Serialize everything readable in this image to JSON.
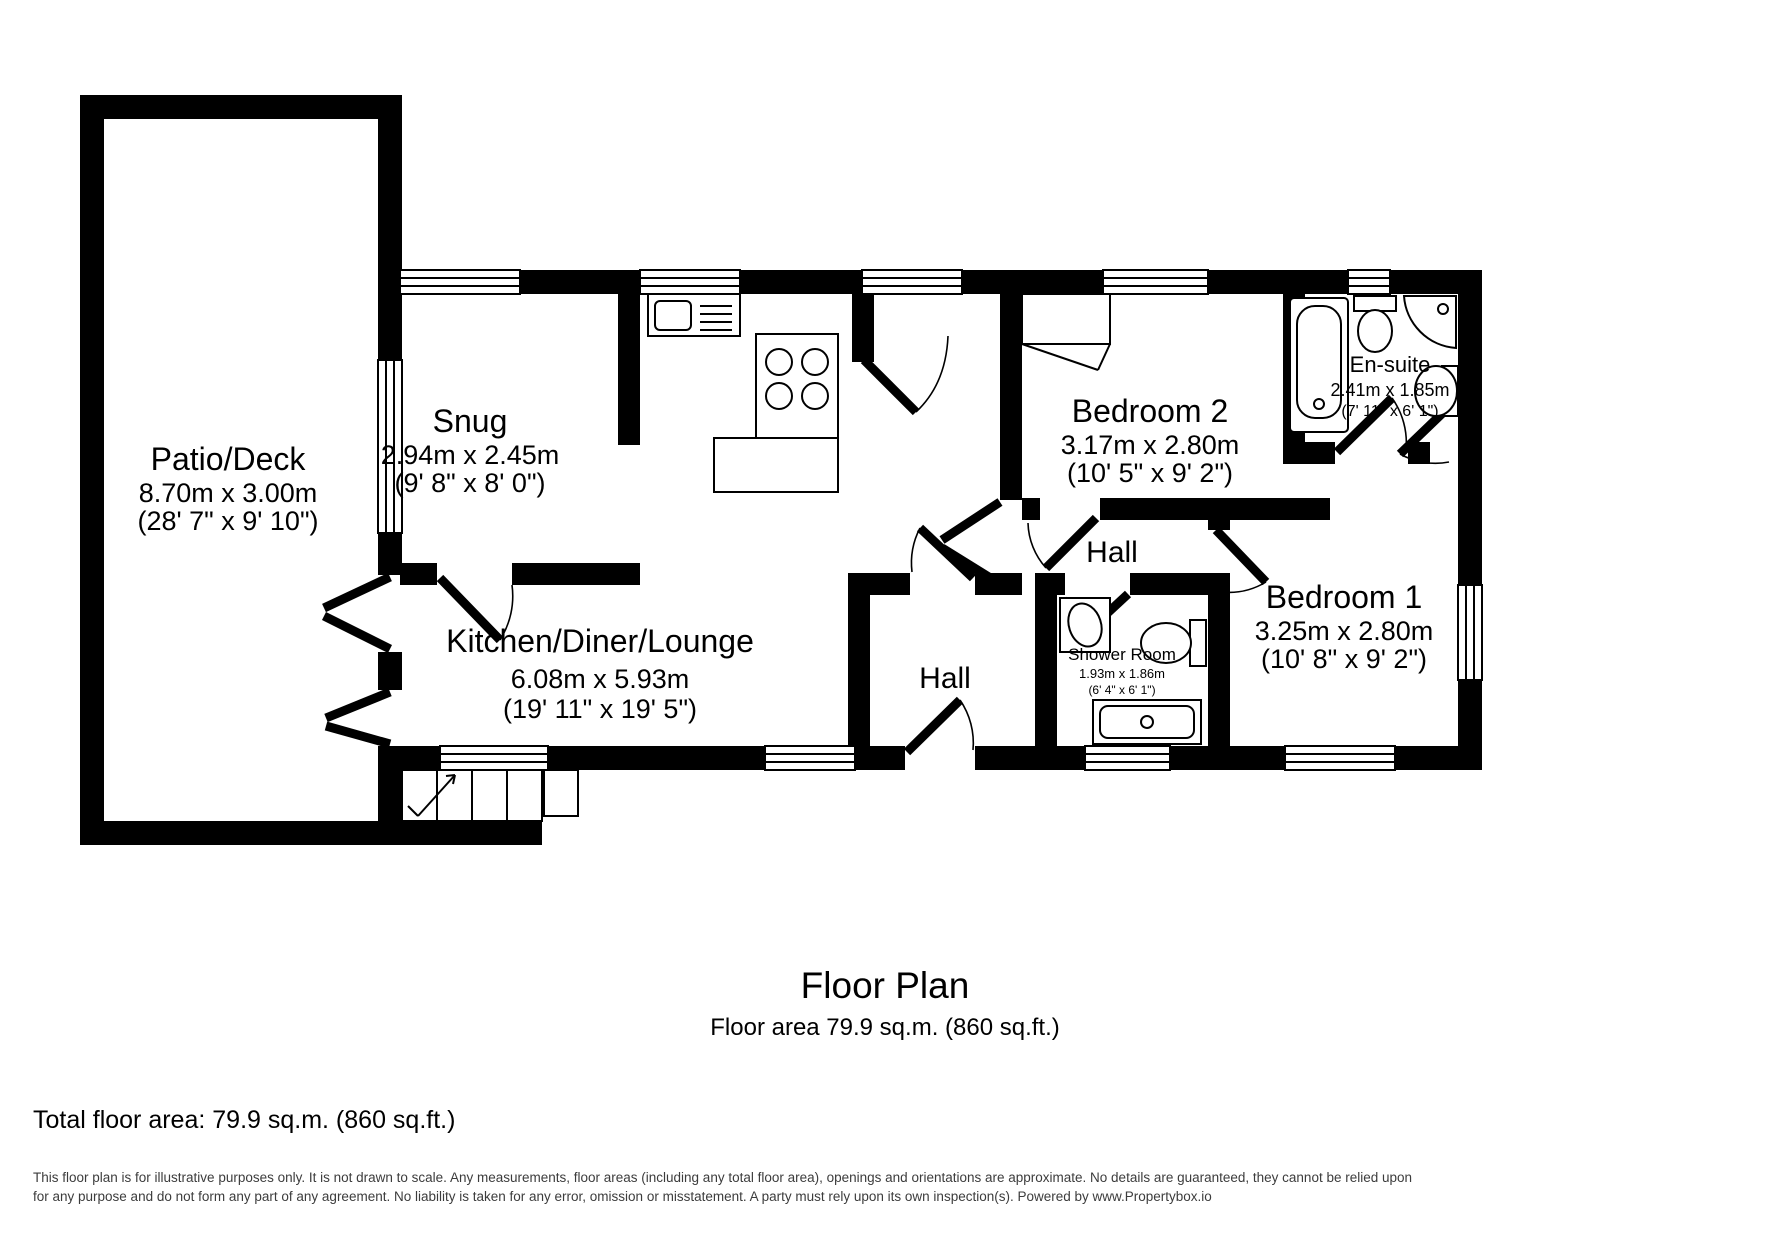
{
  "plan": {
    "title": "Floor Plan",
    "subtitle": "Floor area 79.9 sq.m. (860 sq.ft.)",
    "total": "Total floor area: 79.9 sq.m. (860 sq.ft.)",
    "disclaimer1": "This floor plan is for illustrative purposes only. It is not drawn to scale. Any measurements, floor areas (including any total floor area), openings and orientations are approximate. No details are guaranteed, they cannot be relied upon",
    "disclaimer2": "for any purpose and do not form any part of any agreement. No liability is taken for any error, omission or misstatement. A party must rely upon its own inspection(s). Powered by www.Propertybox.io"
  },
  "rooms": {
    "patio": {
      "name": "Patio/Deck",
      "metric": "8.70m x 3.00m",
      "imperial": "(28' 7\" x 9' 10\")"
    },
    "snug": {
      "name": "Snug",
      "metric": "2.94m x 2.45m",
      "imperial": "(9' 8\" x 8' 0\")"
    },
    "kitchen": {
      "name": "Kitchen/Diner/Lounge",
      "metric": "6.08m x 5.93m",
      "imperial": "(19' 11\" x 19' 5\")"
    },
    "bedroom2": {
      "name": "Bedroom 2",
      "metric": "3.17m x 2.80m",
      "imperial": "(10' 5\" x 9' 2\")"
    },
    "ensuite": {
      "name": "En-suite",
      "metric": "2.41m x 1.85m",
      "imperial": "(7' 11\" x 6' 1\")"
    },
    "hall_upper": {
      "name": "Hall"
    },
    "hall_lower": {
      "name": "Hall"
    },
    "shower": {
      "name": "Shower Room",
      "metric": "1.93m x 1.86m",
      "imperial": "(6' 4\" x 6' 1\")"
    },
    "bedroom1": {
      "name": "Bedroom 1",
      "metric": "3.25m x 2.80m",
      "imperial": "(10' 8\" x 9' 2\")"
    }
  },
  "colors": {
    "wall": "#000000",
    "background": "#ffffff",
    "disclaimer_text": "#3c3c3c"
  }
}
